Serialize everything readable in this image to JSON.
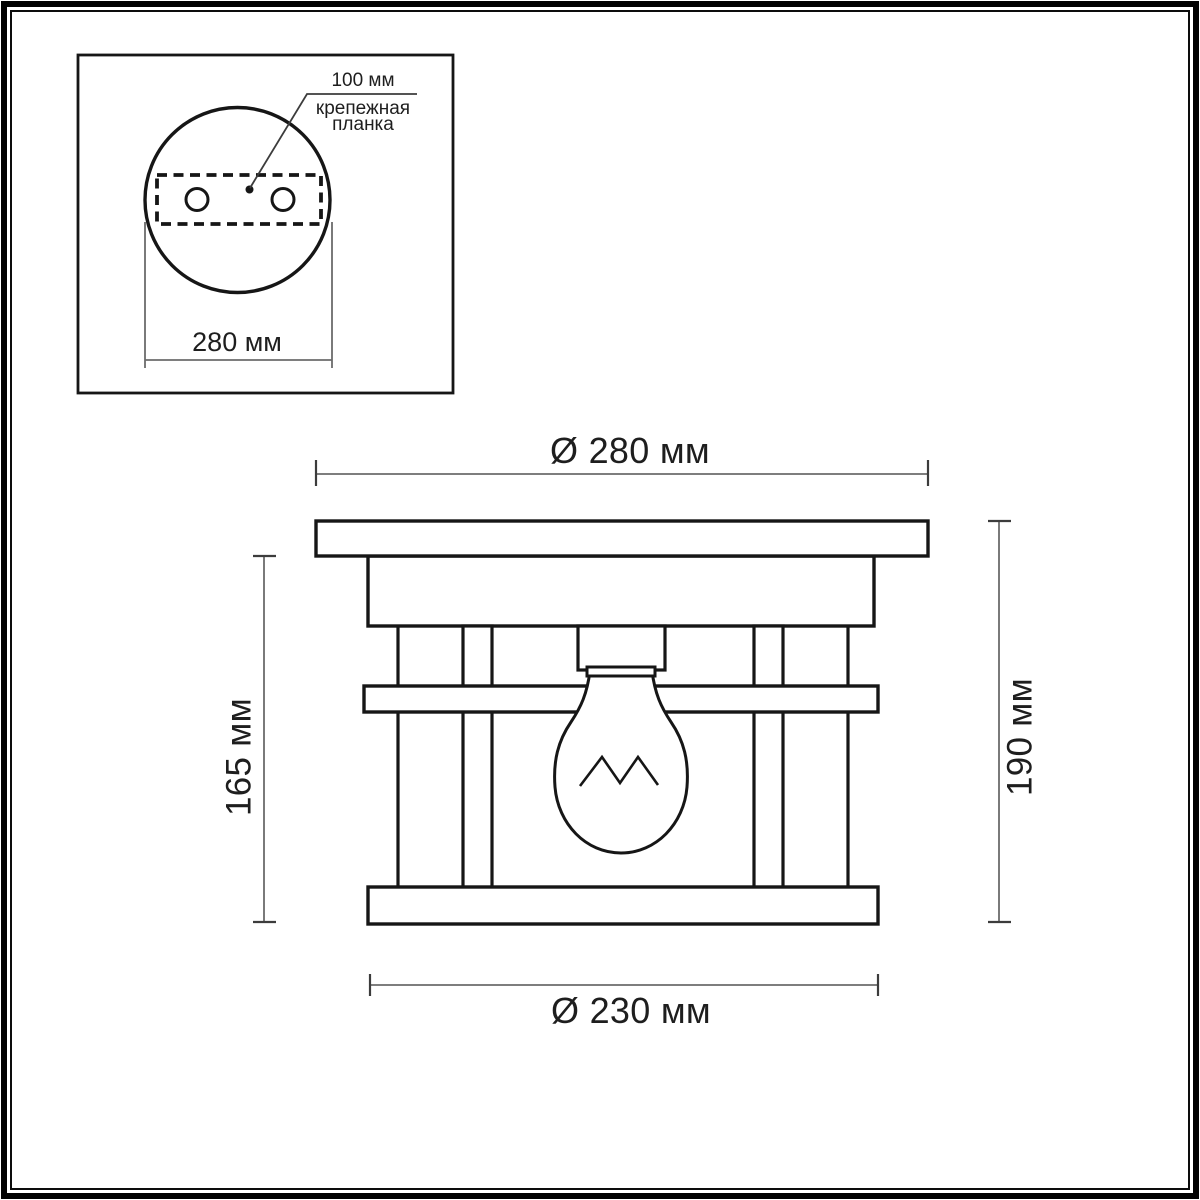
{
  "colors": {
    "background": "#ffffff",
    "frame": "#000000",
    "drawing_line": "#161616",
    "dimension_line": "#6b6b6b",
    "text": "#1e1e1e"
  },
  "inset_top_view": {
    "callout_value": "100 мм",
    "callout_caption": "крепежная\nпланка",
    "width_dim": "280 мм"
  },
  "side_view": {
    "top_diameter": "Ø 280 мм",
    "bottom_diameter": "Ø 230 мм",
    "body_height": "165 мм",
    "total_height": "190 мм"
  }
}
